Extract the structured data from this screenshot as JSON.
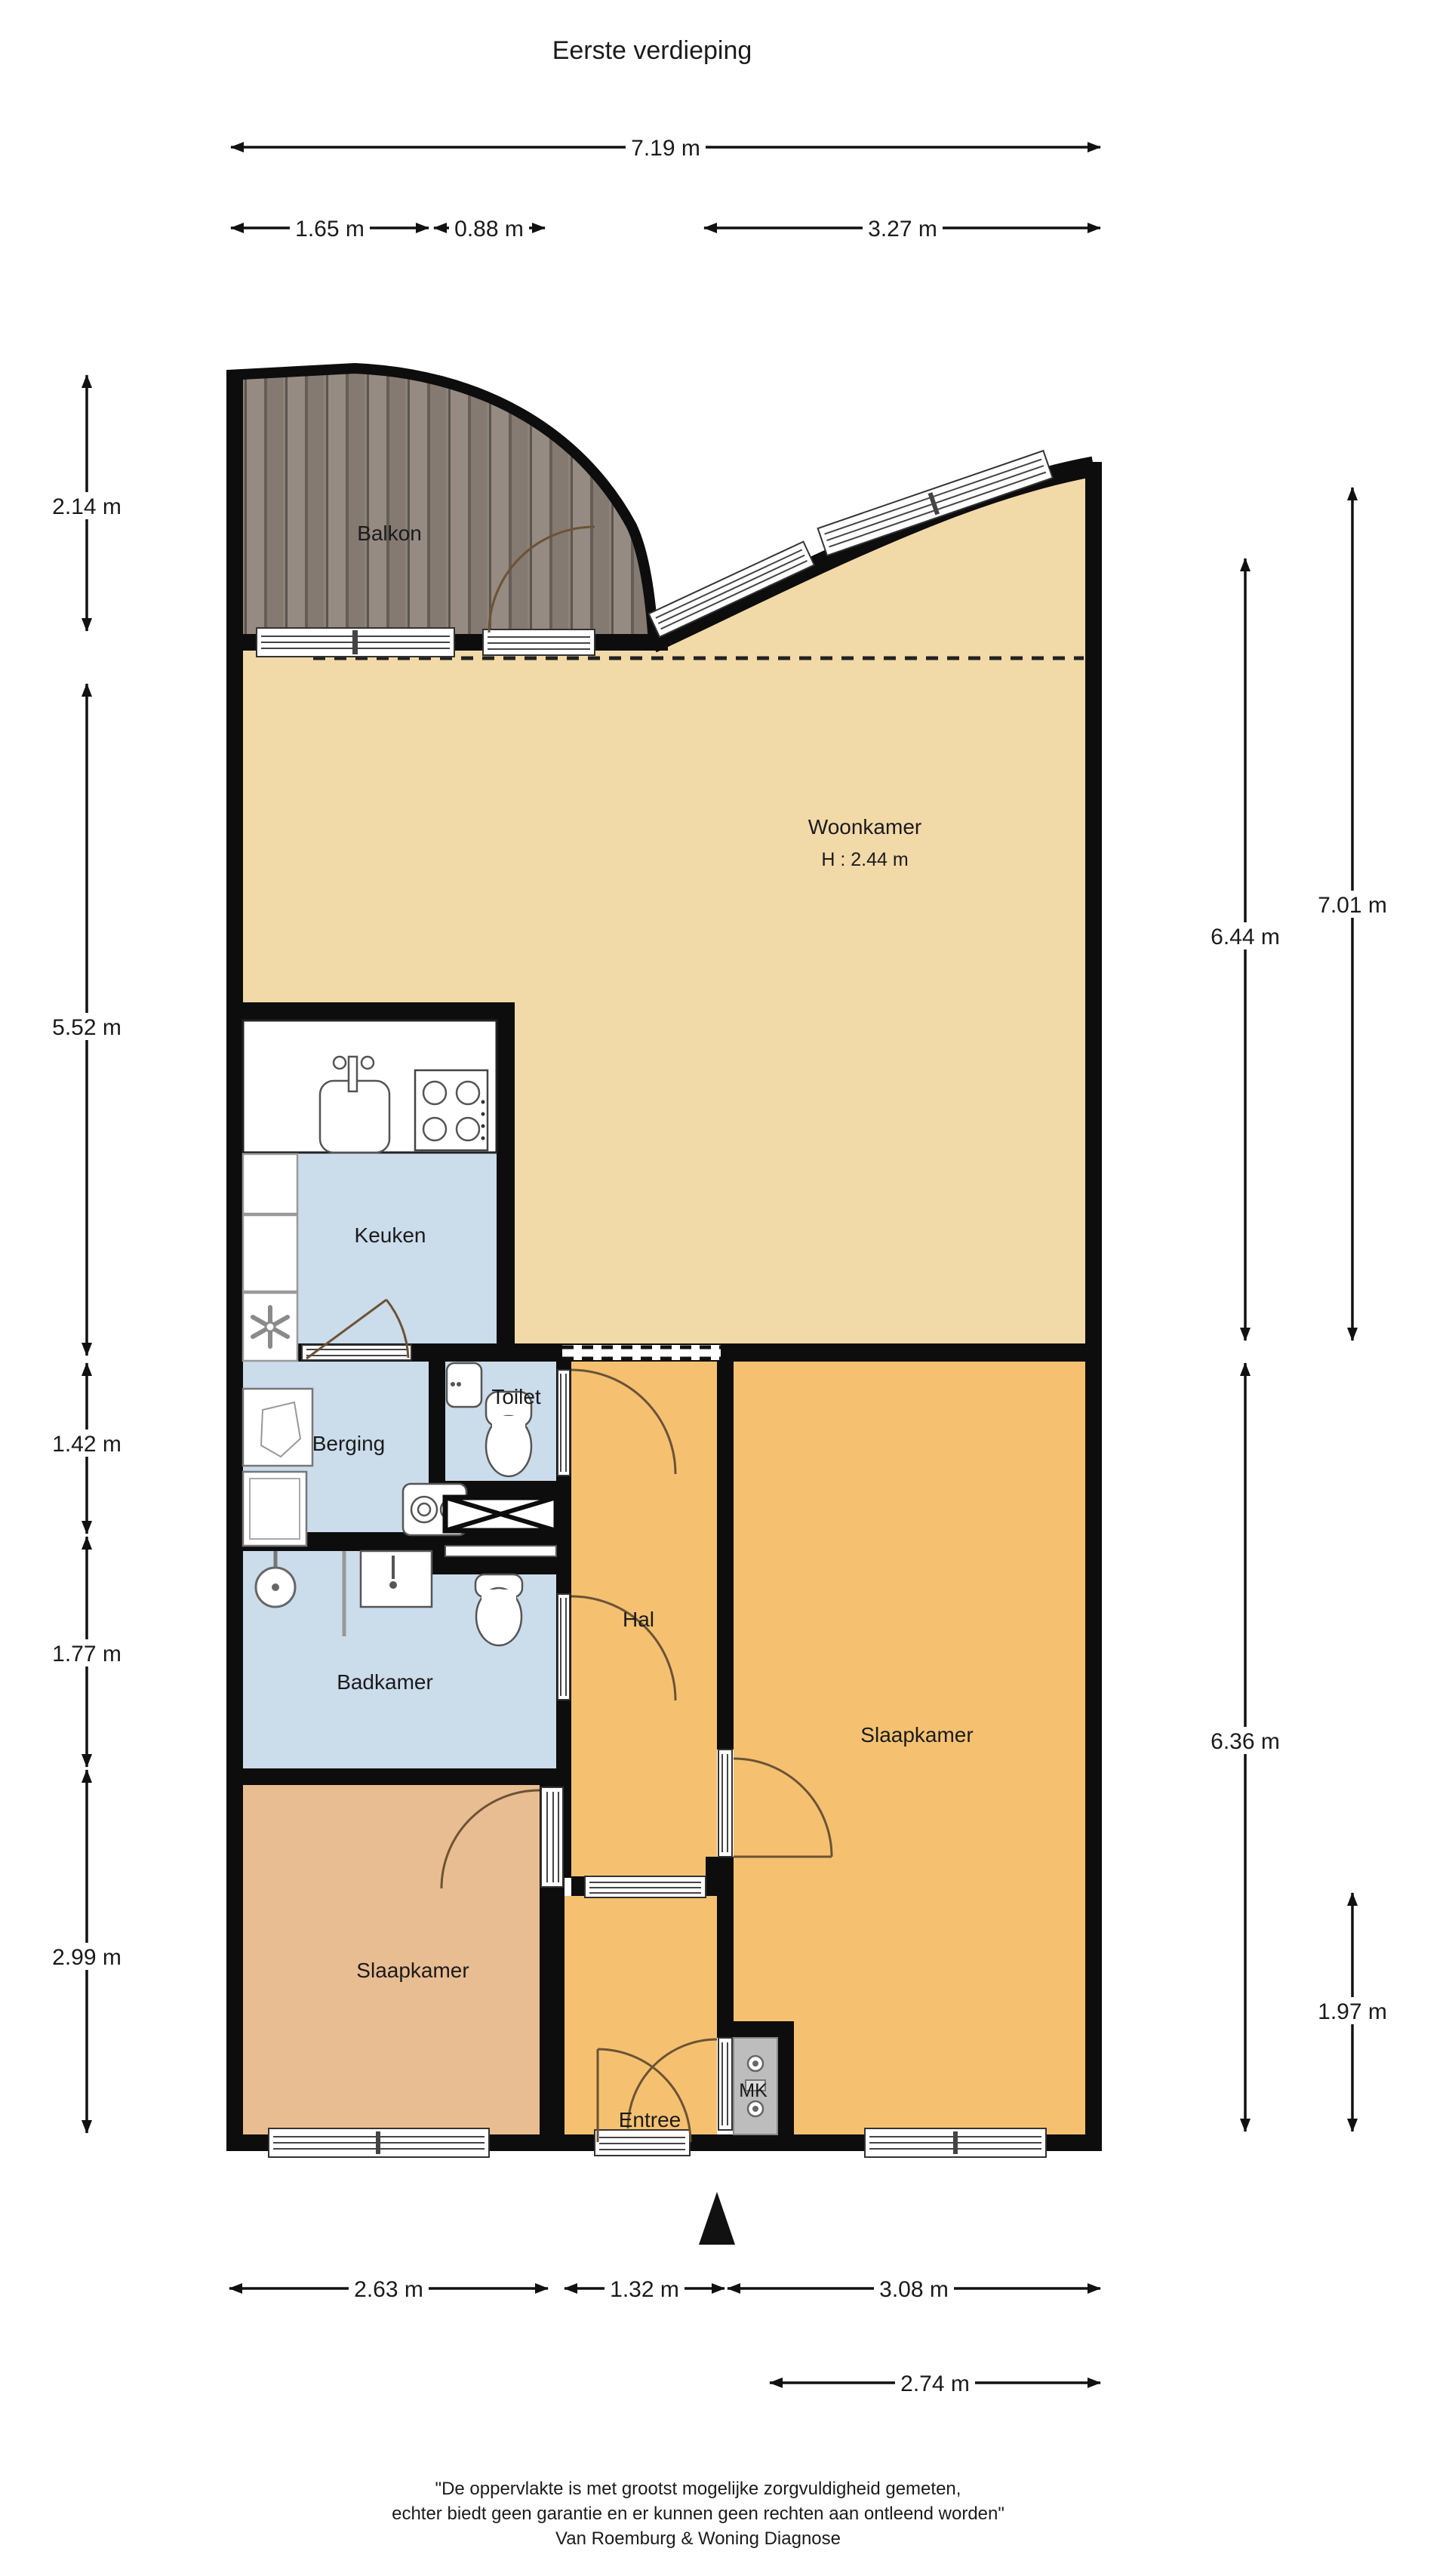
{
  "title": "Eerste verdieping",
  "rooms": {
    "balkon": {
      "label": "Balkon"
    },
    "woonkamer": {
      "label": "Woonkamer",
      "height_label": "H : 2.44 m"
    },
    "keuken": {
      "label": "Keuken"
    },
    "berging": {
      "label": "Berging"
    },
    "toilet": {
      "label": "Toilet"
    },
    "hal": {
      "label": "Hal"
    },
    "badkamer": {
      "label": "Badkamer"
    },
    "slaapkamer_left": {
      "label": "Slaapkamer"
    },
    "slaapkamer_right": {
      "label": "Slaapkamer"
    },
    "entree": {
      "label": "Entree"
    },
    "mk": {
      "label": "MK"
    }
  },
  "dimensions": {
    "top": [
      {
        "label": "7.19 m"
      },
      {
        "label": "1.65 m"
      },
      {
        "label": "0.88 m"
      },
      {
        "label": "3.27 m"
      }
    ],
    "left": [
      {
        "label": "2.14 m"
      },
      {
        "label": "5.52 m"
      },
      {
        "label": "1.42 m"
      },
      {
        "label": "1.77 m"
      },
      {
        "label": "2.99 m"
      }
    ],
    "right": [
      {
        "label": "7.01 m"
      },
      {
        "label": "6.44 m"
      },
      {
        "label": "6.36 m"
      },
      {
        "label": "1.97 m"
      }
    ],
    "bottom": [
      {
        "label": "2.63 m"
      },
      {
        "label": "1.32 m"
      },
      {
        "label": "3.08 m"
      },
      {
        "label": "2.74 m"
      }
    ]
  },
  "footer": {
    "line1": "\"De oppervlakte is met grootst mogelijke zorgvuldigheid gemeten,",
    "line2": "echter biedt geen garantie en er kunnen geen rechten aan ontleend worden\"",
    "line3": "Van Roemburg & Woning Diagnose"
  },
  "colors": {
    "wall": "#0d0d0d",
    "woonkamer": "#F2D9A8",
    "hal": "#F5C171",
    "slaapkamer_left": "#E9BD92",
    "wet_rooms": "#CBDCEB",
    "mk": "#BDBDBD",
    "wood": "#8C8279"
  }
}
